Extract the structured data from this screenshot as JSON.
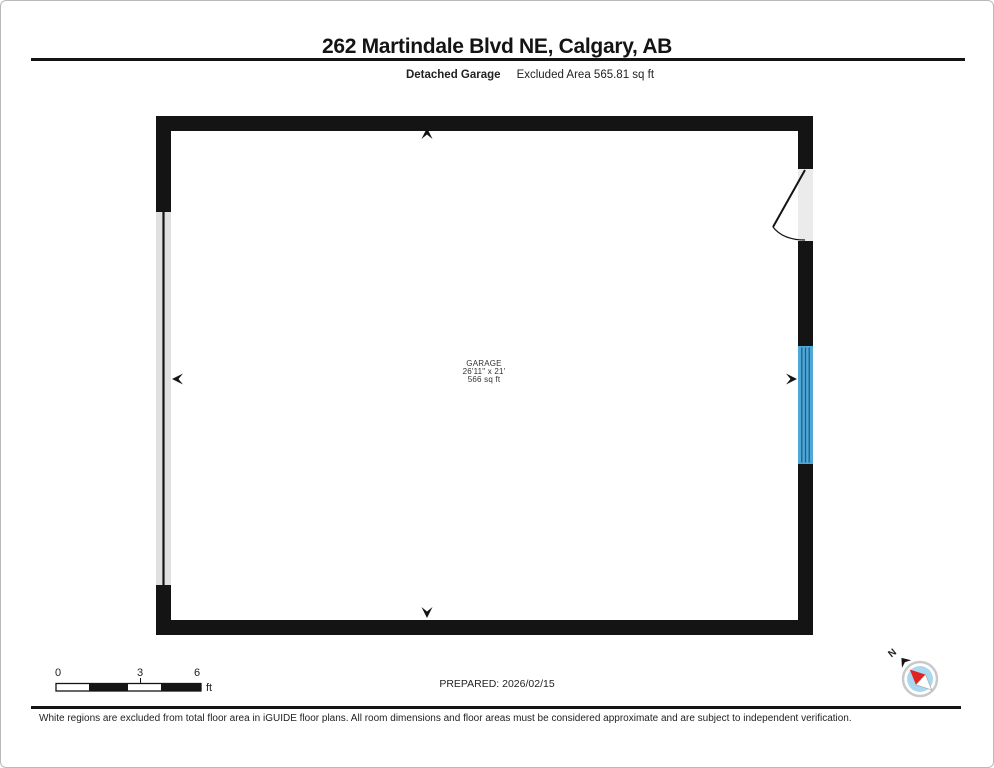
{
  "header": {
    "title": "262 Martindale Blvd NE, Calgary, AB",
    "floor_label": "Detached Garage",
    "excluded_area_label": "Excluded Area 565.81 sq ft"
  },
  "room": {
    "name": "GARAGE",
    "dimensions": "26'11\" x 21'",
    "area": "566 sq ft"
  },
  "scale_bar": {
    "ticks": [
      "0",
      "3",
      "6"
    ],
    "unit": "ft"
  },
  "prepared_label": "PREPARED: 2026/02/15",
  "compass": {
    "north_label": "N"
  },
  "colors": {
    "wall": "#141414",
    "garage_door_fill": "#e0e0e0",
    "door_opening_fill": "#ebebeb",
    "window_fill": "#4fa8d8",
    "window_line": "#1c5f87",
    "compass_ring": "#c9c9c9",
    "compass_face": "#a9d9ef",
    "compass_needle_red": "#e02424"
  },
  "footer": {
    "disclaimer": "White regions are excluded from total floor area in iGUIDE floor plans. All room dimensions and floor areas must be considered approximate and are subject to independent verification."
  }
}
